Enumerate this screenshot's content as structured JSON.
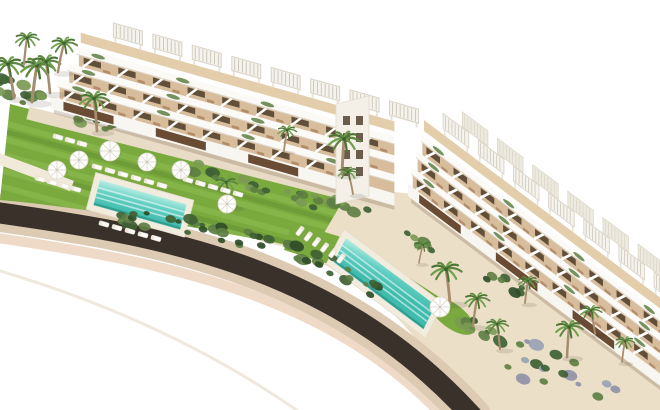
{
  "scene": {
    "width": 660,
    "height": 410,
    "viewBox": "0 0 660 410",
    "background": "#ffffff",
    "palette": {
      "roadDark": "#39312a",
      "roadEdge": "#dccab2",
      "roadEdgeLower": "#eedac7",
      "sand": "#ecdfc8",
      "path": "#e9dcc6",
      "walkway": "#f1e9da",
      "lawn": "#7aa93e",
      "lawnLight": "#8fbf52",
      "lawnDark": "#5d8a33",
      "buildingWhite": "#f8f6f1",
      "buildingShade": "#e8e2d6",
      "parapetEdge": "#d9d2c5",
      "terraceFloor": "#d8bd9c",
      "deckFloor": "#e3cdab",
      "glazing": "#54422f",
      "cladding": "#6a4b33",
      "loungerTan": "#b28d68",
      "loungerWhite": "#fcfbf8",
      "pergolaSlat": "#c9c2b4",
      "pergolaFill": "#f5f3ed",
      "pergolaEdge": "#dcd6ca",
      "poolDeck": "#f2ecdf",
      "waterLight": "#b9ede3",
      "waterMid": "#62cfc2",
      "waterDeep": "#3fbcae",
      "trunk": "#a68d6f",
      "frond1": "#5d8742",
      "frond2": "#6fa04e",
      "frond3": "#4c7535",
      "shrubDark": "#3f6134",
      "shrubMid": "#5d7f43",
      "shrubLight": "#7b9a55",
      "shrubLavender": "#8f93a8",
      "umbrella": "#ffffff",
      "umbrellaRib": "#d9d3c6",
      "shoreline": "#efe8dc",
      "towerFill": "#f4f0e8"
    },
    "road": {
      "center": "M -14 211 C 150 234, 330 260, 472 416",
      "lowerEdge": "M -16 236 C 148 260, 328 288, 450 424",
      "widths": {
        "edge": 38,
        "asphalt": 21,
        "lower": 10
      }
    },
    "shoreline": "M -10 268 Q 170 320, 305 416",
    "sand": "M150 212 L340 186 L412 194 L676 396 L676 410 L452 410 C432 352 400 300 296 250 Z",
    "pathAlongBuilding": {
      "d": "M28 113 L382 203",
      "width": 13
    },
    "walkway": {
      "d": "M-6 157 L72 186",
      "width": 11
    },
    "lawn1": "M10 104 L348 192 L314 250 C200 228 90 208 0 200 Z",
    "lawnStripes": {
      "count": 5,
      "y0": 122,
      "step": 16,
      "len": 352,
      "slope": 96
    },
    "lawn2": [
      "M292 222 L354 241 L338 267 L284 250 Z",
      "M352 241 L447 302 L435 319 L338 265 Z"
    ],
    "lawnPatch": {
      "cx": 452,
      "cy": 316,
      "rx": 27,
      "ry": 12,
      "rot": 37
    },
    "pools": [
      {
        "name": "pool-1",
        "origin": [
          100,
          180
        ],
        "u": [
          0.962,
          0.272
        ],
        "v": [
          -0.25,
          0.968
        ],
        "len": 90,
        "wid": 26,
        "deckPad": 6
      },
      {
        "name": "pool-2",
        "origin": [
          346,
          238
        ],
        "u": [
          0.8,
          0.6
        ],
        "v": [
          -0.452,
          0.892
        ],
        "len": 112,
        "wid": 27,
        "deckPad": 6
      }
    ],
    "shrubPalettes": {
      "dark": [
        "#3f6134",
        "#5d7f43",
        "#2f4d28"
      ],
      "mixed": [
        "#5d7f43",
        "#7b9a55",
        "#3f6134"
      ],
      "lavender": [
        "#8f93a8",
        "#5d7f43",
        "#9aa2b4",
        "#3f6134"
      ]
    },
    "shrubs": [
      {
        "cx": 20,
        "cy": 92,
        "rx": 26,
        "ry": 10,
        "rot": 15,
        "n": 12,
        "pal": "mixed"
      },
      {
        "cx": 150,
        "cy": 223,
        "rx": 30,
        "ry": 9,
        "rot": 12,
        "n": 10,
        "pal": "dark"
      },
      {
        "cx": 212,
        "cy": 231,
        "rx": 26,
        "ry": 8,
        "rot": 14,
        "n": 9,
        "pal": "dark"
      },
      {
        "cx": 264,
        "cy": 244,
        "rx": 26,
        "ry": 8,
        "rot": 16,
        "n": 9,
        "pal": "dark"
      },
      {
        "cx": 316,
        "cy": 259,
        "rx": 26,
        "ry": 9,
        "rot": 20,
        "n": 9,
        "pal": "dark"
      },
      {
        "cx": 364,
        "cy": 284,
        "rx": 24,
        "ry": 9,
        "rot": 30,
        "n": 8,
        "pal": "dark"
      },
      {
        "cx": 300,
        "cy": 197,
        "rx": 22,
        "ry": 7,
        "rot": 16,
        "n": 8,
        "pal": "mixed"
      },
      {
        "cx": 347,
        "cy": 209,
        "rx": 20,
        "ry": 7,
        "rot": 20,
        "n": 7,
        "pal": "mixed"
      },
      {
        "cx": 560,
        "cy": 374,
        "rx": 62,
        "ry": 20,
        "rot": 20,
        "n": 18,
        "pal": "lavender"
      },
      {
        "cx": 482,
        "cy": 332,
        "rx": 26,
        "ry": 10,
        "rot": 35,
        "n": 9,
        "pal": "mixed"
      },
      {
        "cx": 612,
        "cy": 322,
        "rx": 24,
        "ry": 9,
        "rot": 35,
        "n": 8,
        "pal": "dark"
      },
      {
        "cx": 96,
        "cy": 121,
        "rx": 18,
        "ry": 6,
        "rot": 15,
        "n": 7,
        "pal": "mixed"
      },
      {
        "cx": 205,
        "cy": 171,
        "rx": 20,
        "ry": 6,
        "rot": 14,
        "n": 7,
        "pal": "mixed"
      },
      {
        "cx": 257,
        "cy": 186,
        "rx": 18,
        "ry": 6,
        "rot": 15,
        "n": 7,
        "pal": "mixed"
      },
      {
        "cx": 420,
        "cy": 240,
        "rx": 18,
        "ry": 6,
        "rot": 30,
        "n": 6,
        "pal": "mixed"
      },
      {
        "cx": 505,
        "cy": 285,
        "rx": 20,
        "ry": 7,
        "rot": 33,
        "n": 7,
        "pal": "dark"
      }
    ],
    "buildings": [
      {
        "name": "building-left",
        "matrix": [
          0.962,
          0.272,
          0,
          1,
          50,
          108
        ],
        "length": 358,
        "groundH": 12,
        "floors": 3,
        "terraceH": 11,
        "parapetH": 8,
        "roofEdgeH": 5,
        "deckH": 10,
        "floorShift": 10,
        "cellW": 36,
        "pergolas": {
          "count": 8,
          "x0": 36,
          "spacing": 41,
          "w": 30,
          "h": 14,
          "legH": 5
        },
        "backRow": false
      },
      {
        "name": "building-right",
        "matrix": [
          0.799,
          0.601,
          0,
          1,
          408,
          196
        ],
        "length": 336,
        "groundH": 12,
        "floors": 3,
        "terraceH": 12,
        "parapetH": 8,
        "roofEdgeH": 5,
        "deckH": 11,
        "floorShift": 6,
        "cellW": 34,
        "pergolas": {
          "count": 7,
          "x0": 26,
          "spacing": 44,
          "w": 32,
          "h": 15,
          "legH": 6
        },
        "backRow": true
      }
    ],
    "tower": {
      "pts": "336,104 369,96 369,196 336,204",
      "windowCols": [
        343,
        356
      ],
      "windowRows": [
        116,
        133,
        150,
        167
      ],
      "windowW": 7,
      "windowH": 9
    },
    "palms": [
      [
        14,
        98,
        1.3,
        -6
      ],
      [
        32,
        102,
        1.4,
        5
      ],
      [
        50,
        93,
        1.2,
        -4
      ],
      [
        24,
        64,
        1.0,
        3
      ],
      [
        58,
        72,
        1.1,
        6
      ],
      [
        97,
        131,
        1.25,
        -3
      ],
      [
        231,
        207,
        0.95,
        -5
      ],
      [
        284,
        151,
        0.8,
        3
      ],
      [
        342,
        174,
        1.35,
        2
      ],
      [
        353,
        194,
        0.85,
        -5
      ],
      [
        450,
        303,
        1.3,
        -4
      ],
      [
        473,
        326,
        1.05,
        4
      ],
      [
        500,
        349,
        0.95,
        -3
      ],
      [
        525,
        303,
        0.85,
        3
      ],
      [
        567,
        357,
        1.15,
        2
      ],
      [
        595,
        334,
        0.9,
        -4
      ],
      [
        622,
        362,
        0.8,
        3
      ],
      [
        419,
        263,
        0.7,
        4
      ]
    ],
    "umbrellas": [
      [
        57,
        170,
        9
      ],
      [
        79,
        160,
        9
      ],
      [
        110,
        151,
        10
      ],
      [
        147,
        162,
        9
      ],
      [
        181,
        170,
        9
      ],
      [
        227,
        204,
        9
      ],
      [
        440,
        307,
        10
      ]
    ],
    "loungerRows": [
      {
        "x": 97,
        "y": 167,
        "dx": 13,
        "dy": 3.7,
        "n": 6,
        "rot": 16
      },
      {
        "x": 40,
        "y": 179,
        "dx": 12,
        "dy": 3.4,
        "n": 4,
        "rot": 16
      },
      {
        "x": 104,
        "y": 224,
        "dx": 13,
        "dy": 3.6,
        "n": 5,
        "rot": 16
      },
      {
        "x": 188,
        "y": 180,
        "dx": 12.5,
        "dy": 3.5,
        "n": 5,
        "rot": 16
      },
      {
        "x": 58,
        "y": 137,
        "dx": 12,
        "dy": 3.4,
        "n": 3,
        "rot": 16
      },
      {
        "x": 300,
        "y": 231,
        "dx": 8.2,
        "dy": 5.5,
        "n": 6,
        "rot": 127
      }
    ]
  }
}
